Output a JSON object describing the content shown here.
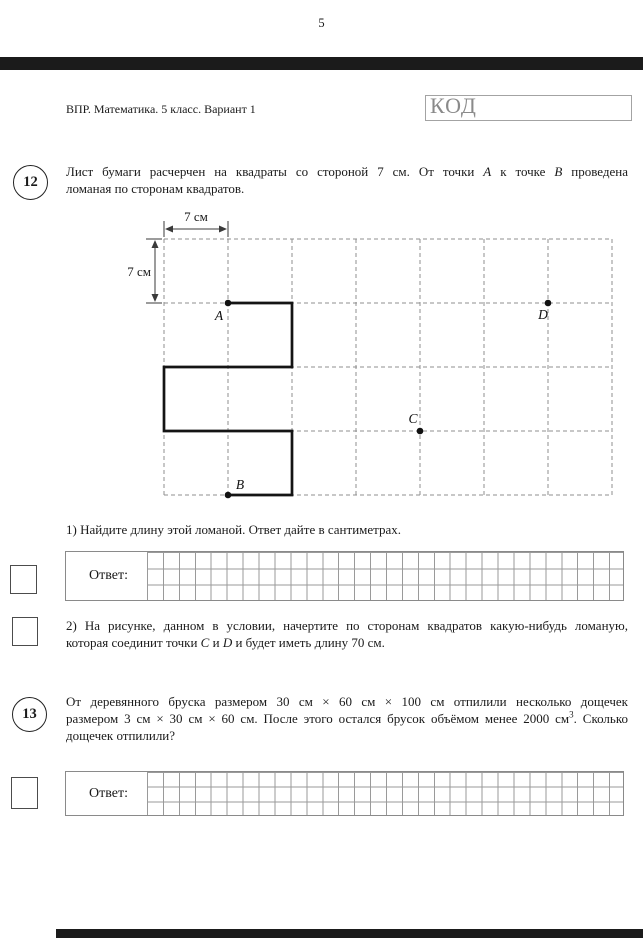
{
  "page_number": "5",
  "header": {
    "title": "ВПР. Математика. 5 класс. Вариант 1",
    "code_label": "КОД"
  },
  "problem12": {
    "number": "12",
    "intro_line1": [
      {
        "t": "Лист бумаги расчерчен на квадраты со стороной 7 см. От точки "
      },
      {
        "t": "A",
        "s": "i"
      },
      {
        "t": " к точке "
      },
      {
        "t": "B",
        "s": "i"
      },
      {
        "t": " проведена"
      }
    ],
    "intro_line2": "ломаная по сторонам квадратов.",
    "part1_text": "1) Найдите длину этой ломаной. Ответ дайте в сантиметрах.",
    "part2_line1": "2) На рисунке, данном в условии, начертите по сторонам квадратов какую-нибудь ломаную,",
    "part2_line2": [
      {
        "t": "которая соединит точки "
      },
      {
        "t": "C",
        "s": "i"
      },
      {
        "t": " и "
      },
      {
        "t": "D",
        "s": "i"
      },
      {
        "t": " и будет иметь длину 70 см."
      }
    ],
    "answer_label": "Ответ:"
  },
  "problem13": {
    "number": "13",
    "line1": "От деревянного бруска размером  30 см × 60 см × 100 см  отпилили несколько дощечек",
    "line2": [
      {
        "t": "размером  3 см × 30 см × 60 см.  После этого остался брусок объёмом менее 2000 см"
      },
      {
        "t": "3",
        "s": "sup"
      },
      {
        "t": ". Сколько"
      }
    ],
    "line3": "дощечек отпилили?",
    "answer_label": "Ответ:"
  },
  "figure": {
    "dim_top": "7 см",
    "dim_left": "7 см",
    "cell_cm": 7,
    "cols": 7,
    "rows": 4,
    "polyline_cells": [
      [
        1,
        1
      ],
      [
        2,
        1
      ],
      [
        2,
        2
      ],
      [
        0,
        2
      ],
      [
        0,
        3
      ],
      [
        2,
        3
      ],
      [
        2,
        4
      ],
      [
        1,
        4
      ]
    ],
    "points": [
      {
        "label": "A",
        "col": 1,
        "row": 1,
        "ldx": -9,
        "ldy": 17
      },
      {
        "label": "B",
        "col": 1,
        "row": 4,
        "ldx": 12,
        "ldy": -6
      },
      {
        "label": "C",
        "col": 4,
        "row": 3,
        "ldx": -7,
        "ldy": -8
      },
      {
        "label": "D",
        "col": 6,
        "row": 1,
        "ldx": -5,
        "ldy": 16
      }
    ]
  },
  "answer_grid": {
    "columns": 30,
    "rows": 3
  }
}
